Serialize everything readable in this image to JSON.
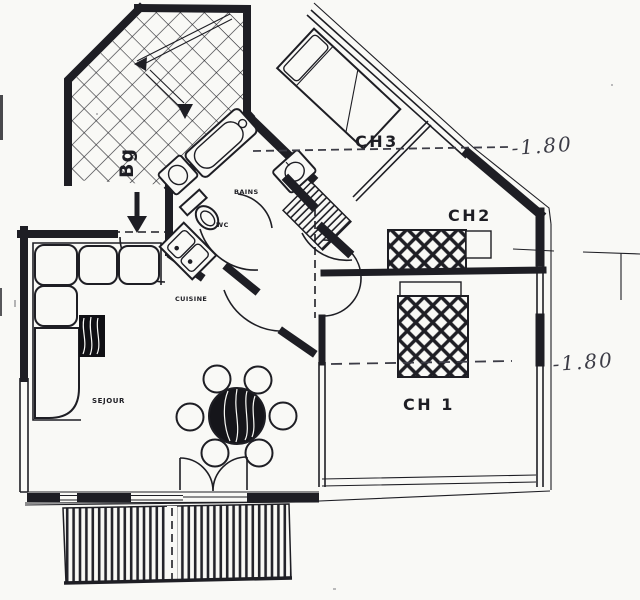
{
  "labels": {
    "sejour": "SEJOUR",
    "cuisine": "CUISINE",
    "bains": "BAINS",
    "wc": "WC",
    "ch1": "CH 1",
    "ch2": "CH2",
    "ch3": "CH3",
    "stairwell": "Bg",
    "dim_upper": "-1.80",
    "dim_lower": "-1.80"
  },
  "colors": {
    "ink": "#1e1e24",
    "paper": "#f9f9f6",
    "pencil": "#3c3c46"
  }
}
